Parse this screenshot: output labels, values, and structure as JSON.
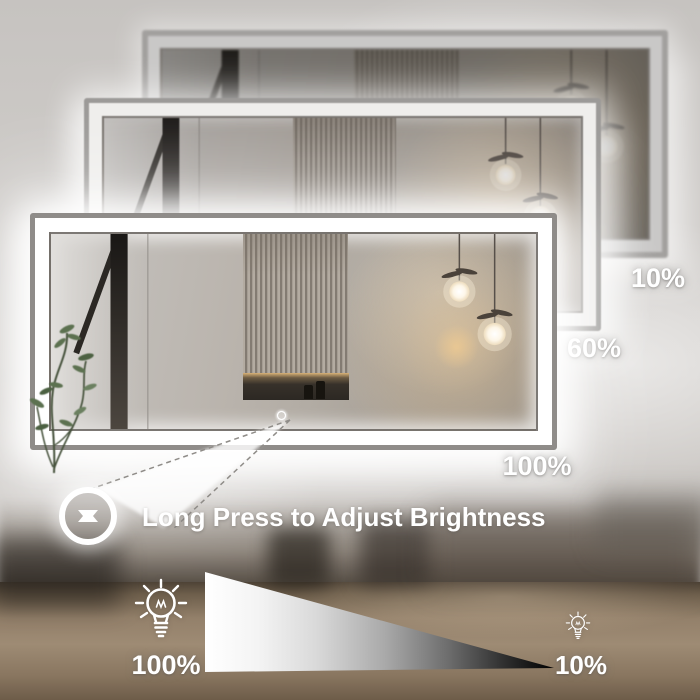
{
  "annotation": {
    "instruction": "Long Press to Adjust Brightness",
    "adjust_button_icon": "up-down-arrows-icon"
  },
  "mirrors": [
    {
      "position": "back",
      "brightness_label": "10%"
    },
    {
      "position": "middle",
      "brightness_label": "60%"
    },
    {
      "position": "front",
      "brightness_label": "100%"
    }
  ],
  "brightness_scale": {
    "high_label": "100%",
    "high_icon": "bulb-bright-icon",
    "low_label": "10%",
    "low_icon": "bulb-dim-icon",
    "gradient_start": "#ffffff",
    "gradient_end": "#000000"
  },
  "touch_controls": {
    "icon": "touch-control-dots",
    "count": 3
  },
  "colors": {
    "led_frame_full": "#ffffff",
    "led_frame_mid": "#efeeec",
    "led_frame_low": "#c9c8c7",
    "wall_gray": "#cbc8c5",
    "counter_brown": "#97846d",
    "warm_light": "#e9c28a",
    "label_text": "#ffffff"
  }
}
